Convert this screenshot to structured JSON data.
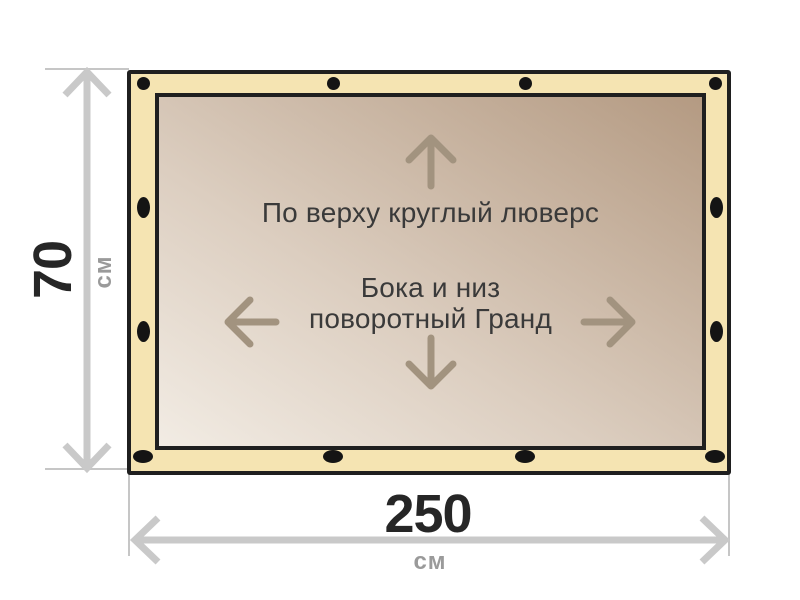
{
  "diagram": {
    "material": {
      "top_note": "По верху круглый люверс",
      "center_note_line1": "Бока и низ",
      "center_note_line2": "поворотный Гранд"
    },
    "dimensions": {
      "height": {
        "value": "70",
        "unit": "см"
      },
      "width": {
        "value": "250",
        "unit": "см"
      }
    }
  },
  "colors": {
    "tarp-edge": "#f5e4b2",
    "tarp-stroke": "#1f1f1f",
    "canvas-light": "#f2ece4",
    "canvas-dark": "#b49a82",
    "eyelet": "#141414",
    "print-arrow": "#a2937f",
    "note-text": "#3a3a3a",
    "dim-arrow": "#c9c9c9",
    "dim-line": "#c6c6c6",
    "dim-value": "#262626",
    "dim-unit": "#9a9a9a"
  }
}
